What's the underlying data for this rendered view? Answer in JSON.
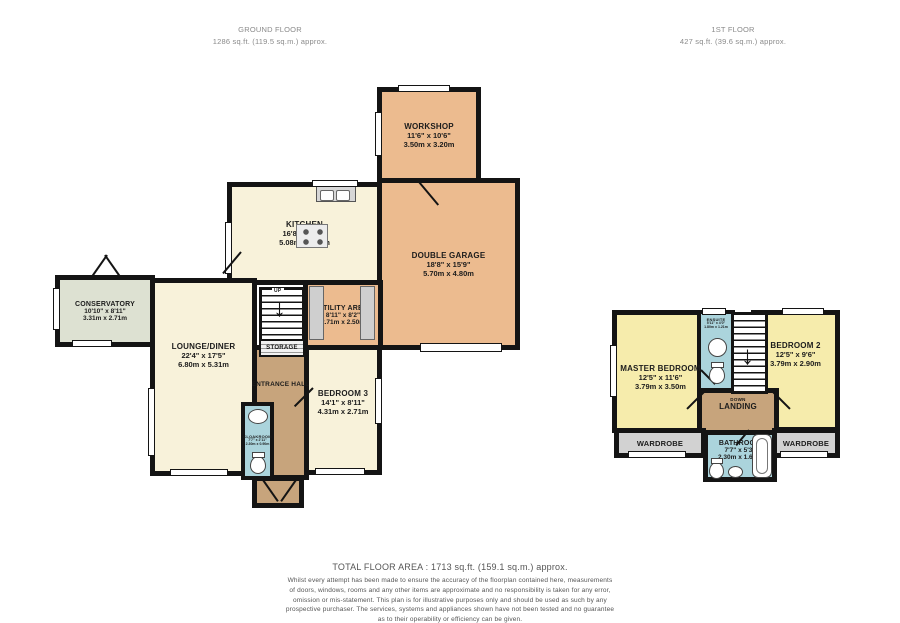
{
  "headers": {
    "ground": {
      "title": "GROUND FLOOR",
      "area": "1286 sq.ft. (119.5 sq.m.) approx."
    },
    "first": {
      "title": "1ST FLOOR",
      "area": "427 sq.ft. (39.6 sq.m.) approx."
    }
  },
  "rooms": {
    "workshop": {
      "name": "WORKSHOP",
      "dims_ft": "11'6\" x 10'6\"",
      "dims_m": "3.50m x 3.20m"
    },
    "kitchen": {
      "name": "KITCHEN",
      "dims_ft": "16'8\" x 10'6\"",
      "dims_m": "5.08m x 3.20m"
    },
    "garage": {
      "name": "DOUBLE GARAGE",
      "dims_ft": "18'8\" x 15'9\"",
      "dims_m": "5.70m x 4.80m"
    },
    "utility": {
      "name": "UTILITY AREA",
      "dims_ft": "8'11\" x 8'2\"",
      "dims_m": "2.71m x 2.50m"
    },
    "conservatory": {
      "name": "CONSERVATORY",
      "dims_ft": "10'10\" x 8'11\"",
      "dims_m": "3.31m x 2.71m"
    },
    "lounge": {
      "name": "LOUNGE/DINER",
      "dims_ft": "22'4\" x 17'5\"",
      "dims_m": "6.80m x 5.31m"
    },
    "bedroom3": {
      "name": "BEDROOM 3",
      "dims_ft": "14'1\" x 8'11\"",
      "dims_m": "4.31m x 2.71m"
    },
    "entrance_hall": {
      "name": "ENTRANCE HALL"
    },
    "storage": {
      "name": "STORAGE"
    },
    "cloakroom": {
      "name": "CLOAKROOM",
      "dims_ft": "7'7\" x 2'11\"",
      "dims_m": "2.30m x 0.90m"
    },
    "master": {
      "name": "MASTER BEDROOM",
      "dims_ft": "12'5\" x 11'6\"",
      "dims_m": "3.79m x 3.50m"
    },
    "bedroom2": {
      "name": "BEDROOM 2",
      "dims_ft": "12'5\" x 9'6\"",
      "dims_m": "3.79m x 2.90m"
    },
    "ensuite": {
      "name": "ENSUITE",
      "dims_ft": "5'11\" x 4'0\"",
      "dims_m": "1.80m x 1.21m"
    },
    "landing": {
      "name": "LANDING"
    },
    "wardrobe_left": {
      "name": "WARDROBE"
    },
    "wardrobe_right": {
      "name": "WARDROBE"
    },
    "bathroom": {
      "name": "BATHROOM",
      "dims_ft": "7'7\" x 5'3\"",
      "dims_m": "2.30m x 1.60m"
    }
  },
  "stairs": {
    "up_label": "UP",
    "down_label": "DOWN",
    "arrow_down": "↓"
  },
  "footer": {
    "total": "TOTAL FLOOR AREA : 1713 sq.ft. (159.1 sq.m.) approx.",
    "disclaimer": [
      "Whilst every attempt has been made to ensure the accuracy of the floorplan contained here, measurements",
      "of doors, windows, rooms and any other items are approximate and no responsibility is taken for any error,",
      "omission or mis-statement. This plan is for illustrative purposes only and should be used as such by any",
      "prospective purchaser. The services, systems and appliances shown have not been tested and no guarantee",
      "as to their operability or efficiency can be given.",
      "Made with Metropix ©2023"
    ]
  },
  "colors": {
    "room_tan": "#ECBB8F",
    "room_cream": "#F8F2DA",
    "room_yellow": "#F6ECAC",
    "room_green": "#DDE1D2",
    "room_blue": "#ABD4DC",
    "hall_tan": "#C7A47C",
    "wardrobe_gray": "#D2D2D2",
    "wall": "#141414"
  }
}
